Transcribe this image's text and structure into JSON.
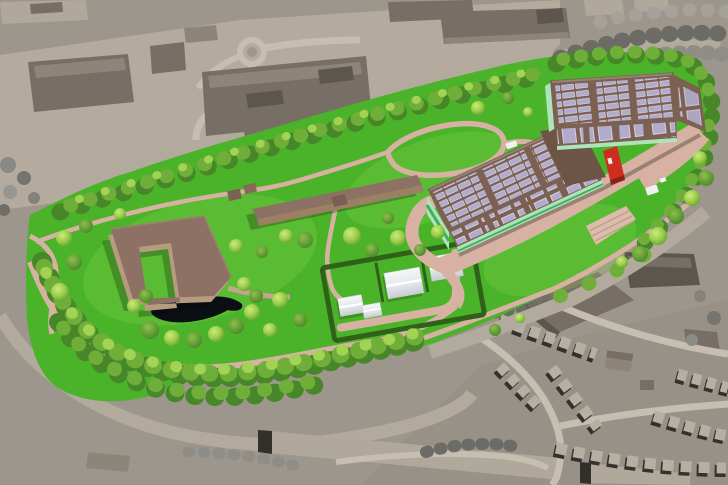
{
  "meta": {
    "kind": "aerial-3d-architectural-rendering",
    "description": "Bird's-eye 3D visualization of a landscaped green campus site containing a large solar-roofed building complex, a courtyard building, a linear building, a walled garden with white greenhouses and a pond, surrounded by monochrome gray urban context with industrial buildings, a roundabout and terraced housing"
  },
  "colors": {
    "ground": "#9d968c",
    "ground2": "#b4ab9e",
    "ground3": "#928c84",
    "road": "#b2aa9d",
    "road2": "#c6beb0",
    "ctxd": "#776f66",
    "ctxm": "#8d857a",
    "ctxl": "#b0a89b",
    "ctxdd": "#5d564f",
    "house": "#b6afa2",
    "houseS": "#34312c",
    "gt": "#8f8d88",
    "gtd": "#6d6b66",
    "gtl": "#a5a29c",
    "lawn": "#4bb32a",
    "lawn2": "#8edc4e",
    "td": "#47872a",
    "tm": "#6fae38",
    "tl": "#a2d355",
    "th": "#c3e775",
    "path": "#d7b2a2",
    "pond": "#0b0f14",
    "roof": "#8d7164",
    "roofd": "#7a6052",
    "wall": "#b69b81",
    "walld": "#9b8064",
    "mroof": "#7c6152",
    "mroofd": "#6d5546",
    "solar": "#b2accc",
    "solar2": "#cfcbe2",
    "mint": "#aee3bb",
    "fgreen": "#44b05e",
    "red": "#cf2d1d",
    "redd": "#8f1f14",
    "tent": "#eef0f2",
    "tentS": "#ccd0d4",
    "hedge": "#2f6119",
    "stepfill": "#dcbcab",
    "stepline": "#c09f8e"
  },
  "scene": {
    "objects": [
      "industrial-buildings",
      "roundabout",
      "context-roads",
      "gray-context-trees",
      "terraced-housing",
      "parkland-lawn",
      "perimeter-tree-belt",
      "pond",
      "courtyard-building",
      "linear-building",
      "garden-sheds",
      "walled-garden",
      "greenhouse-tents",
      "footpath-network",
      "solar-complex",
      "solar-panel-arrays",
      "red-entrance-accent",
      "mint-facade",
      "entrance-plaza",
      "plaza-steps",
      "white-van",
      "white-canopy"
    ]
  }
}
